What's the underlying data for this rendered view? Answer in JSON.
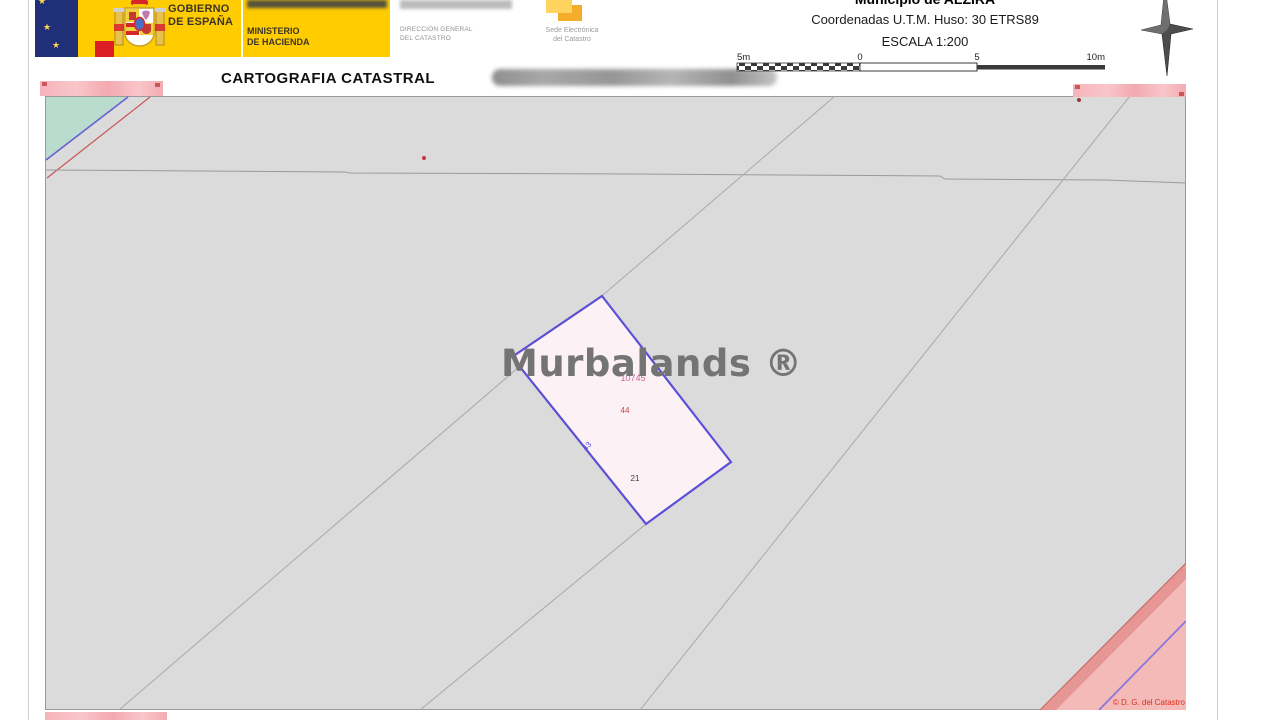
{
  "header": {
    "gobierno": {
      "line1": "GOBIERNO",
      "line2": "DE ESPAÑA"
    },
    "ministerio": {
      "line1": "MINISTERIO",
      "line2": "DE HACIENDA"
    },
    "direccion": {
      "line1": "DIRECCIÓN GENERAL",
      "line2": "DEL CATASTRO"
    },
    "sede": {
      "line1": "Sede Electrónica",
      "line2": "del Catastro"
    },
    "doc_title": "CARTOGRAFIA CATASTRAL",
    "municipio": "Municipio de ALZIRA",
    "coordinates": "Coordenadas U.T.M. Huso: 30 ETRS89",
    "escala": "ESCALA 1:200",
    "scalebar_labels": [
      "5m",
      "0",
      "5",
      "10m"
    ]
  },
  "map": {
    "watermark": "Murbalands ®",
    "parcel_number": "10745",
    "label_44": "44",
    "label_43": "43",
    "label_21": "21",
    "copyright": "© D. G. del Catastro"
  },
  "colors": {
    "brand_yellow": "#FFCC00",
    "map_background": "#DBDBDB",
    "parcel_stroke": "#5B50D6",
    "parcel_fill": "#FCF1F4",
    "pink_zone_fill": "#F3BAB7",
    "redaction_pink": "#F8C0C4",
    "copyright_red": "#D93025"
  }
}
